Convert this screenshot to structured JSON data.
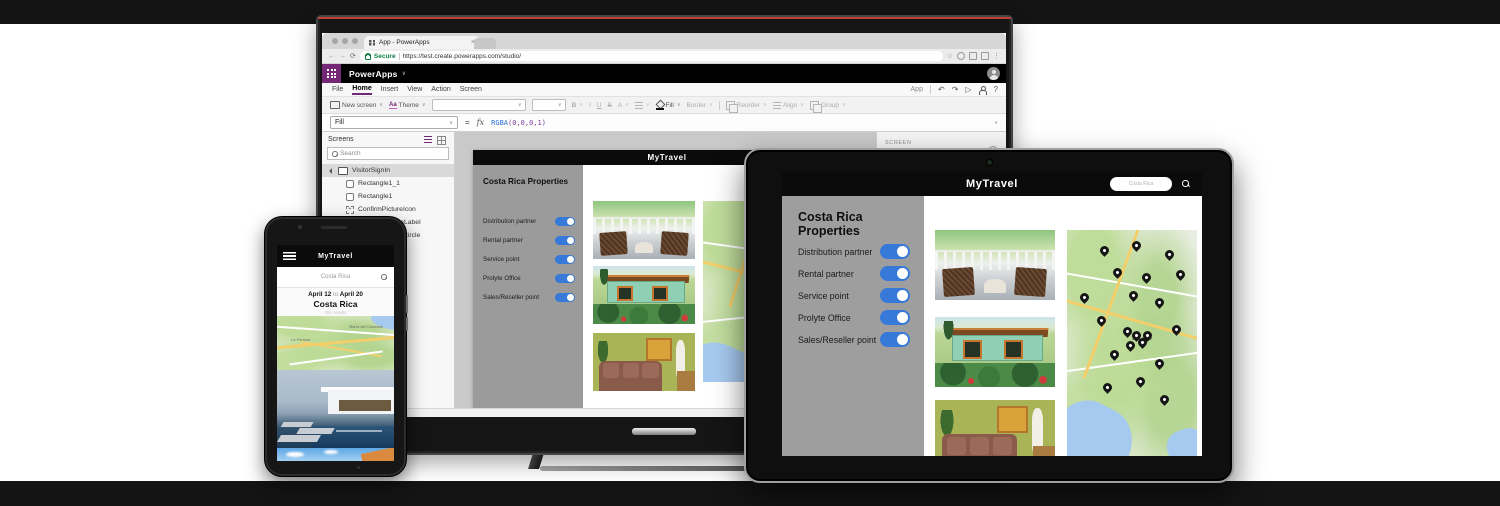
{
  "browser": {
    "tab_title": "App - PowerApps",
    "secure_label": "Secure",
    "url": "https://test.create.powerapps.com/studio/"
  },
  "powerapps": {
    "app_name": "PowerApps",
    "menu": [
      "File",
      "Home",
      "Insert",
      "View",
      "Action",
      "Screen"
    ],
    "menu_right_label": "App",
    "toolbar": {
      "new_screen": "New screen",
      "theme_icon": "Aa",
      "theme": "Theme",
      "bold": "B",
      "italic": "I",
      "underline": "U",
      "strike": "S",
      "font_color": "A",
      "fill": "Fill",
      "border": "Border",
      "reorder": "Reorder",
      "align": "Align",
      "group": "Group"
    },
    "formula": {
      "property": "Fill",
      "fx": "fx",
      "fn": "RGBA",
      "args": "(0,0,0,1)"
    },
    "screens_panel": {
      "title": "Screens",
      "search_placeholder": "Search",
      "tree": [
        {
          "label": "VisitorSignIn",
          "type": "screen",
          "selected": true
        },
        {
          "label": "Rectangle1_1",
          "type": "rectangle"
        },
        {
          "label": "Rectangle1",
          "type": "rectangle"
        },
        {
          "label": "ConfirmPictureIcon",
          "type": "icon"
        },
        {
          "label": "ConfirmPictureLabel",
          "type": "label"
        },
        {
          "label": "ConfirmPictureCircle",
          "type": "circle"
        }
      ]
    },
    "property_panel": {
      "label": "SCREEN",
      "value": "Screen1",
      "info": "i"
    },
    "status_bar": {
      "screen": "Screen1",
      "interaction_label": "Interaction",
      "interaction_value": "Off"
    }
  },
  "app": {
    "title": "MyTravel",
    "sidebar_title": "Costa Rica Properties",
    "search_value": "Costa Rica",
    "toggles": [
      {
        "label": "Distribution partner",
        "on": true
      },
      {
        "label": "Rental partner",
        "on": true
      },
      {
        "label": "Service point",
        "on": true
      },
      {
        "label": "Prolyte Office",
        "on": true
      },
      {
        "label": "Sales/Reseller point",
        "on": true
      }
    ]
  },
  "phone_app": {
    "title": "MyTravel",
    "search_value": "Costa Rica",
    "date_from": "April 12",
    "date_conn": "to",
    "date_to": "April 20",
    "location": "Costa Rica",
    "results": "291 results"
  },
  "maps": {
    "tablet_city_label": "San José",
    "phone_labels": [
      "La Fortuna",
      "Barra del Colorado"
    ],
    "desktop_pins": [
      [
        57,
        13
      ],
      [
        70,
        24
      ],
      [
        44,
        36
      ],
      [
        58,
        44
      ],
      [
        31,
        53
      ],
      [
        52,
        51
      ],
      [
        57,
        54
      ],
      [
        62,
        52
      ],
      [
        60,
        57
      ],
      [
        46,
        62
      ],
      [
        72,
        61
      ],
      [
        55,
        71
      ],
      [
        36,
        77
      ],
      [
        66,
        79
      ]
    ],
    "tablet_pins": [
      [
        28,
        10
      ],
      [
        52,
        8
      ],
      [
        78,
        12
      ],
      [
        38,
        20
      ],
      [
        60,
        22
      ],
      [
        86,
        21
      ],
      [
        12,
        31
      ],
      [
        50,
        30
      ],
      [
        70,
        33
      ],
      [
        25,
        41
      ],
      [
        83,
        45
      ],
      [
        45,
        46
      ],
      [
        52,
        48
      ],
      [
        57,
        51
      ],
      [
        61,
        48
      ],
      [
        48,
        52
      ],
      [
        35,
        56
      ],
      [
        70,
        60
      ],
      [
        55,
        68
      ],
      [
        30,
        71
      ],
      [
        74,
        76
      ]
    ]
  },
  "icons": {
    "chevron": "∨",
    "close": "×",
    "star": "☆",
    "more": "⋮",
    "undo": "↶",
    "redo": "↷",
    "play": "▷",
    "help": "?",
    "back": "←",
    "forward": "→",
    "reload": "⟳",
    "minus": "−",
    "equals": "="
  },
  "colors": {
    "powerapps_purple": "#742774",
    "toggle_blue": "#3779d8",
    "secure_green": "#0b8043",
    "app_header_black": "#0b0b0b",
    "sidebar_gray": "#9e9e9e"
  }
}
